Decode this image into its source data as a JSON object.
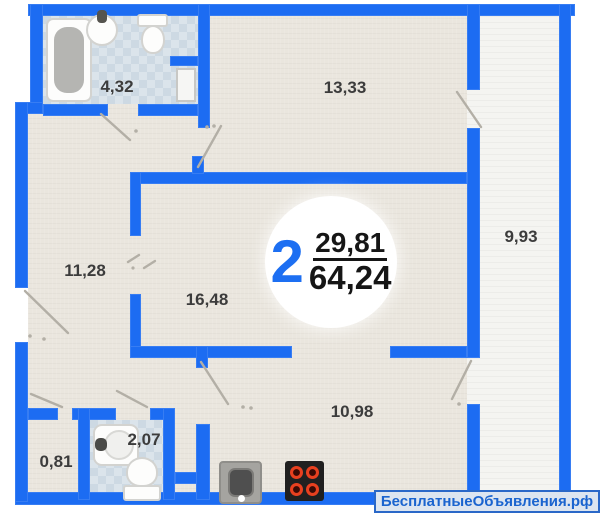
{
  "plan": {
    "badge": {
      "rooms_count": "2",
      "living_area": "29,81",
      "total_area": "64,24"
    },
    "rooms": [
      {
        "id": "bathroom",
        "area": "4,32"
      },
      {
        "id": "room-13",
        "area": "13,33"
      },
      {
        "id": "balcony",
        "area": "9,93"
      },
      {
        "id": "hall",
        "area": "11,28"
      },
      {
        "id": "living-room",
        "area": "16,48"
      },
      {
        "id": "kitchen",
        "area": "10,98"
      },
      {
        "id": "closet",
        "area": "0,81"
      },
      {
        "id": "wc",
        "area": "2,07"
      }
    ],
    "watermark": "БесплатныеОбъявления.рф",
    "colors": {
      "wall": "#1c6cf2",
      "floor": "#eae6de",
      "balcony_floor": "#f4f4f1",
      "tile": "#cdd9e3",
      "accent_blue": "#1d6ff2",
      "watermark_text": "#1a64cf",
      "burner_red": "#e8401f"
    },
    "icons": {
      "bathtub": "css-shape",
      "sink": "css-shape",
      "toilet": "css-shape",
      "stove": "css-shape",
      "kitchen_sink": "css-shape",
      "door_swing": "svg-line"
    }
  }
}
